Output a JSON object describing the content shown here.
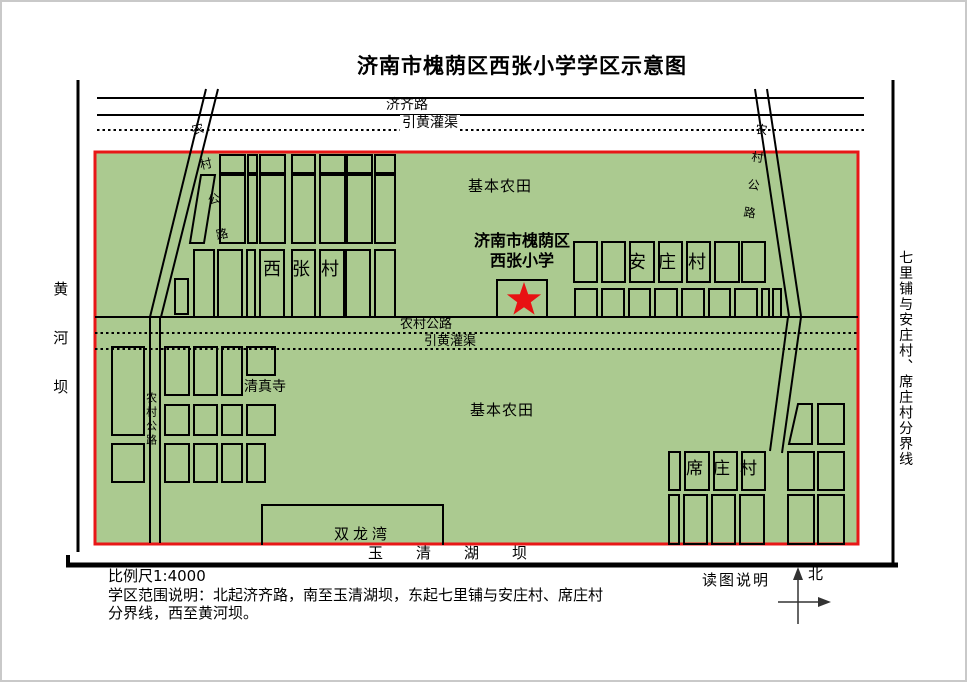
{
  "title": {
    "text": "济南市槐荫区西张小学学区示意图"
  },
  "roads": {
    "jiqi_road": "济齐路",
    "canal_top": "引黄灌渠",
    "rural_road_mid": "农村公路",
    "canal_mid": "引黄灌渠",
    "rural_road_left_diagonal": "农村公路",
    "rural_road_right_diagonal": "农村公路",
    "rural_road_left_vertical": "农村公路"
  },
  "areas": {
    "farmland_top": "基本农田",
    "farmland_bottom": "基本农田",
    "xizhang_village": "西张村",
    "anzhuang_village": "安庄村",
    "xizhuang_village": "席庄村",
    "mosque": "清真寺",
    "shuanglongwan": "双龙湾"
  },
  "school": {
    "line1": "济南市槐荫区",
    "line2": "西张小学"
  },
  "boundaries": {
    "south_dam": "玉清湖坝",
    "west_dam": "黄河坝",
    "east_line": "七里铺与安庄村、席庄村分界线"
  },
  "footer": {
    "scale": "比例尺1:4000",
    "description_line1": "学区范围说明：北起济齐路，南至玉清湖坝，东起七里铺与安庄村、席庄村",
    "description_line2": "分界线，西至黄河坝。",
    "legend_title": "读图说明",
    "north": "北"
  },
  "colors": {
    "district_fill": "#abca90",
    "district_border": "#e81717",
    "star": "#e81212"
  }
}
